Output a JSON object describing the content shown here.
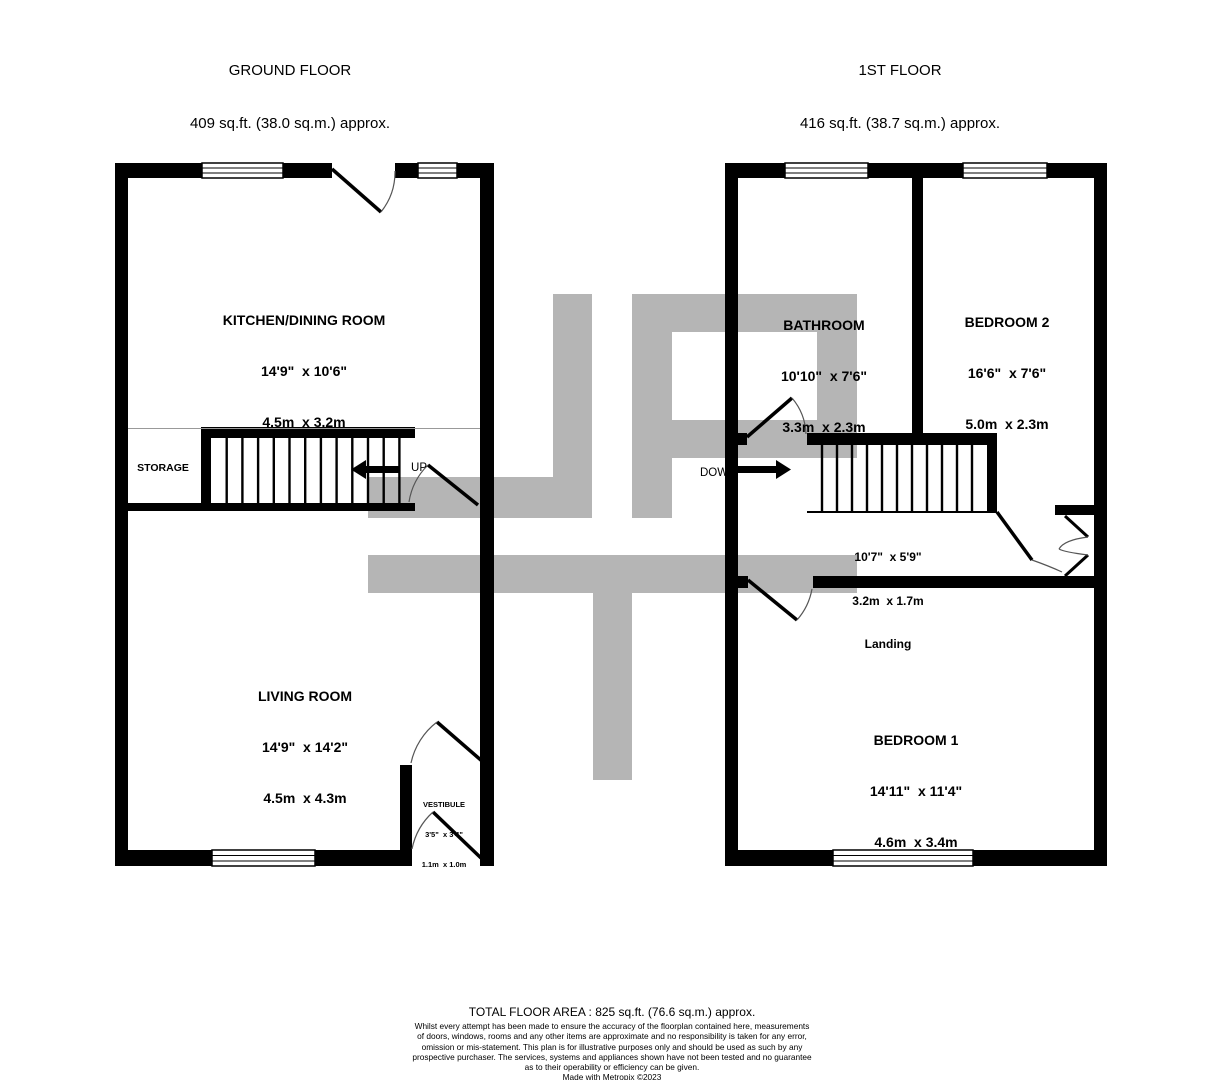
{
  "floors": {
    "ground": {
      "title": "GROUND FLOOR",
      "area": "409 sq.ft. (38.0 sq.m.) approx.",
      "rooms": {
        "kitchen": {
          "name": "KITCHEN/DINING ROOM",
          "imperial": "14'9\"  x 10'6\"",
          "metric": "4.5m  x 3.2m"
        },
        "living": {
          "name": "LIVING ROOM",
          "imperial": "14'9\"  x 14'2\"",
          "metric": "4.5m  x 4.3m"
        },
        "vestibule": {
          "name": "VESTIBULE",
          "imperial": "3'5\"  x 3'4\"",
          "metric": "1.1m  x 1.0m"
        },
        "storage": {
          "name": "STORAGE"
        }
      },
      "stairs_label": "UP"
    },
    "first": {
      "title": "1ST FLOOR",
      "area": "416 sq.ft. (38.7 sq.m.) approx.",
      "rooms": {
        "bathroom": {
          "name": "BATHROOM",
          "imperial": "10'10\"  x 7'6\"",
          "metric": "3.3m  x 2.3m"
        },
        "bedroom2": {
          "name": "BEDROOM 2",
          "imperial": "16'6\"  x 7'6\"",
          "metric": "5.0m  x 2.3m"
        },
        "bedroom1": {
          "name": "BEDROOM 1",
          "imperial": "14'11\"  x 11'4\"",
          "metric": "4.6m  x 3.4m"
        },
        "landing": {
          "name": "Landing",
          "imperial": "10'7\"  x 5'9\"",
          "metric": "3.2m  x 1.7m"
        }
      },
      "stairs_label": "DOWN"
    }
  },
  "footer": {
    "total_area": "TOTAL FLOOR AREA : 825 sq.ft. (76.6 sq.m.) approx.",
    "disclaimer": "Whilst every attempt has been made to ensure the accuracy of the floorplan contained here, measurements\nof doors, windows, rooms and any other items are approximate and no responsibility is taken for any error,\nomission or mis-statement. This plan is for illustrative purposes only and should be used as such by any\nprospective purchaser. The services, systems and appliances shown have not been tested and no guarantee\nas to their operability or efficiency can be given.",
    "credit": "Made with Metropix ©2023"
  },
  "colors": {
    "watermark": "#b5b5b5",
    "wall": "#000000"
  }
}
